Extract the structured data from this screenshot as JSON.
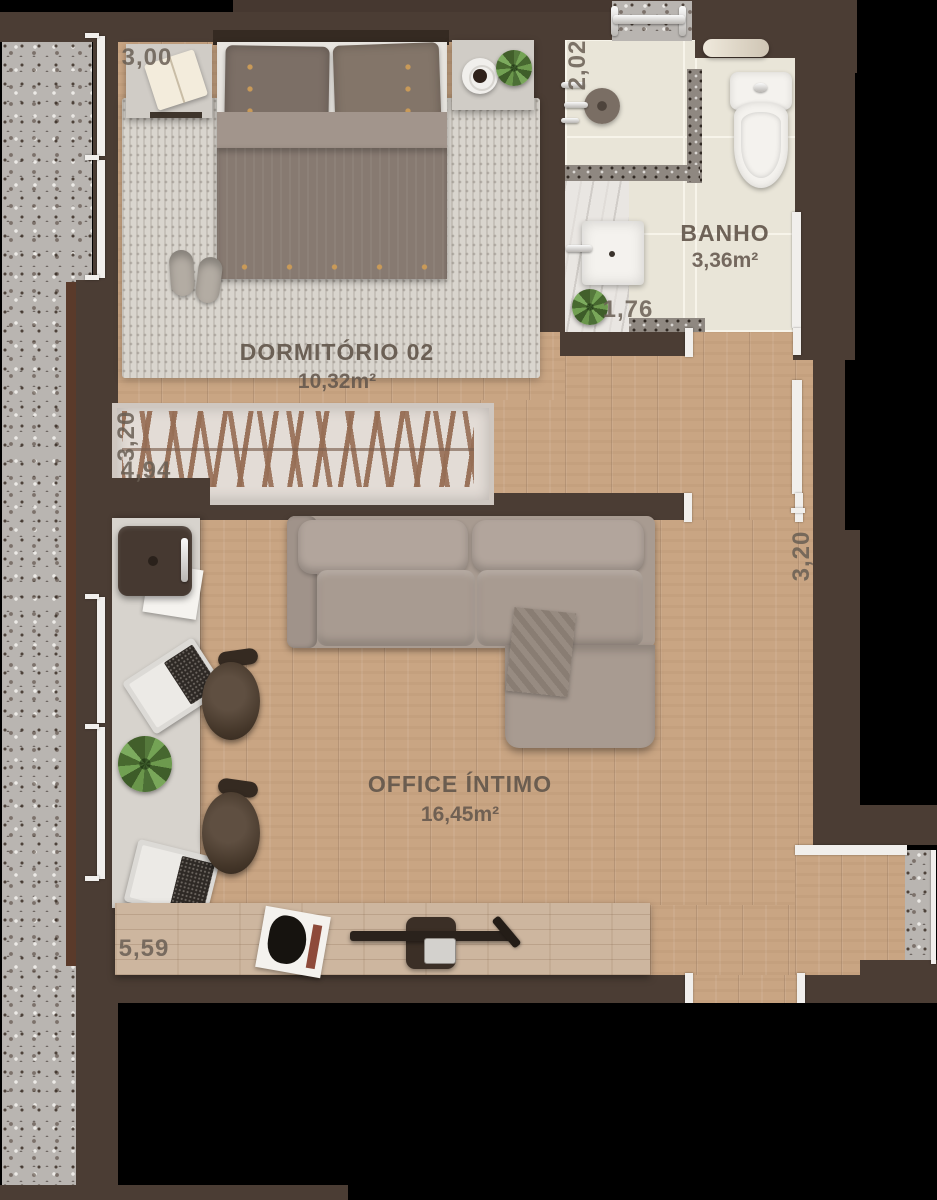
{
  "rooms": {
    "dormitorio": {
      "name": "DORMITÓRIO 02",
      "area": "10,32m²"
    },
    "banho": {
      "name": "BANHO",
      "area": "3,36m²"
    },
    "office": {
      "name": "OFFICE ÍNTIMO",
      "area": "16,45m²"
    }
  },
  "dimensions": {
    "bed_wall": "3,00",
    "shower_depth": "2,02",
    "bath_width": "1,76",
    "closet_depth": "3,20",
    "closet_width": "4,94",
    "office_depth": "3,20",
    "office_width": "5,59"
  },
  "colors": {
    "background": "#000000",
    "wall": "#4b3d34",
    "wood_floor": "#c9a583",
    "console_wood": "#cdb69f",
    "balcony_granite": "#b9b5b1",
    "bathroom_tile": "#e9e5d8",
    "rug": "#d9d5ce",
    "sofa": "#a89b91",
    "plant_green": "#5d7f44",
    "label_text": "#63574c",
    "dimension_text": "#685e54"
  }
}
